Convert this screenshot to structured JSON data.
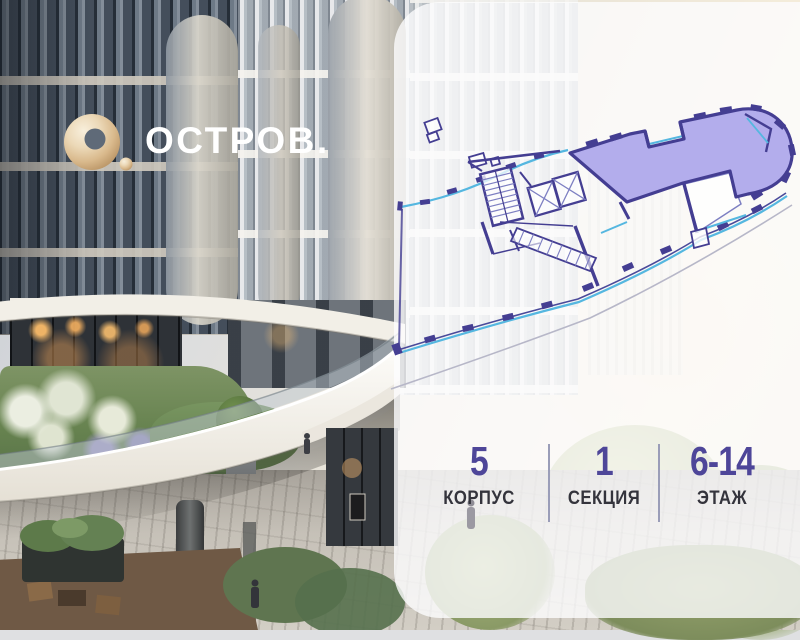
{
  "logo": {
    "text": "ОСТРОВ.",
    "mark_icon": "o-ring-with-dot-icon",
    "gold_color": "#d9b98c",
    "text_color": "#ffffff"
  },
  "panel": {
    "background": "rgba(253,253,254,0.8)"
  },
  "floor_plan": {
    "type": "building-section-plan",
    "highlighted": true,
    "highlighted_unit_fill": "#aca6ea",
    "wall_color": "#443e92",
    "glass_color": "#55b7e0"
  },
  "info_bar": {
    "value_color": "#4e4699",
    "label_color": "#34343c",
    "divider_color": "#9a9db8",
    "items": [
      {
        "value": "5",
        "label": "КОРПУС"
      },
      {
        "value": "1",
        "label": "СЕКЦИЯ"
      },
      {
        "value": "6-14",
        "label": "ЭТАЖ"
      }
    ]
  }
}
